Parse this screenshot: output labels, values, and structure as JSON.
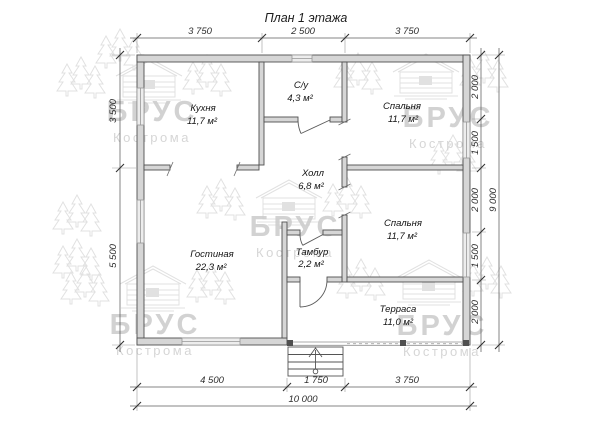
{
  "title": "План 1 этажа",
  "watermark": {
    "brand": "БРУС",
    "city": "Кострома"
  },
  "rooms": {
    "kitchen": {
      "name": "Кухня",
      "area": "11,7 м²"
    },
    "bathroom": {
      "name": "С/у",
      "area": "4,3 м²"
    },
    "bedroom1": {
      "name": "Спальня",
      "area": "11,7 м²"
    },
    "hall": {
      "name": "Холл",
      "area": "6,8 м²"
    },
    "bedroom2": {
      "name": "Спальня",
      "area": "11,7 м²"
    },
    "living": {
      "name": "Гостиная",
      "area": "22,3 м²"
    },
    "vestibule": {
      "name": "Тамбур",
      "area": "2,2 м²"
    },
    "terrace": {
      "name": "Терраса",
      "area": "11,0 м²"
    }
  },
  "dimensions": {
    "top": [
      "3 750",
      "2 500",
      "3 750"
    ],
    "left": [
      "3 500",
      "5 500"
    ],
    "right": [
      "2 000",
      "1 500",
      "2 000",
      "1 500",
      "2 000"
    ],
    "right_total": "9 000",
    "bottom": [
      "4 500",
      "1 750",
      "3 750"
    ],
    "bottom_total": "10 000"
  }
}
